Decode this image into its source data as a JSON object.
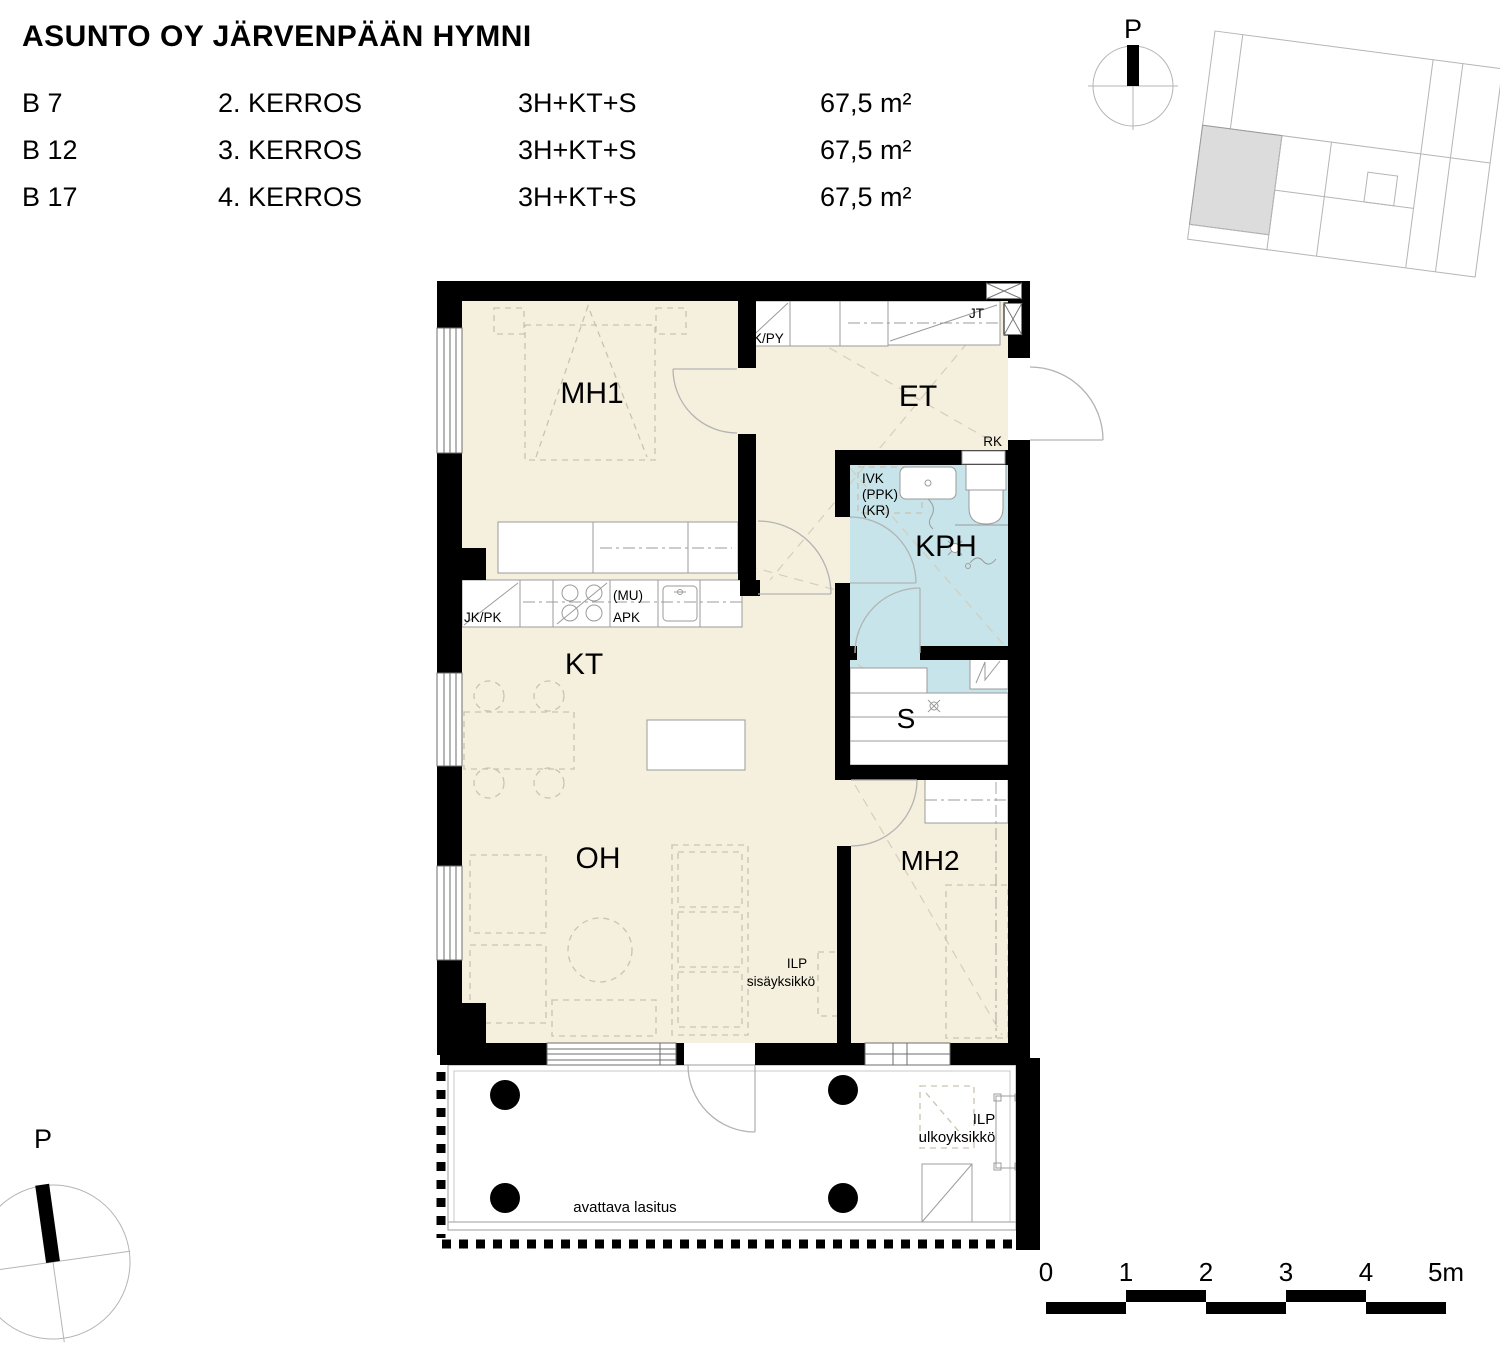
{
  "header": {
    "title": "ASUNTO OY JÄRVENPÄÄN HYMNI"
  },
  "apartments": [
    {
      "unit": "B 7",
      "floor": "2. KERROS",
      "type": "3H+KT+S",
      "area": "67,5 m²"
    },
    {
      "unit": "B 12",
      "floor": "3. KERROS",
      "type": "3H+KT+S",
      "area": "67,5 m²"
    },
    {
      "unit": "B 17",
      "floor": "4. KERROS",
      "type": "3H+KT+S",
      "area": "67,5 m²"
    }
  ],
  "compass_top": {
    "north_label": "P"
  },
  "compass_bottom": {
    "north_label": "P"
  },
  "plan": {
    "rooms": {
      "mh1": "MH1",
      "et": "ET",
      "kph": "KPH",
      "kt": "KT",
      "oh": "OH",
      "s": "S",
      "mh2": "MH2"
    },
    "labels": {
      "sk_py": "SK/PY",
      "jt": "JT",
      "rk": "RK",
      "ivk": "IVK",
      "ppk": "(PPK)",
      "kr": "(KR)",
      "jk_pk": "JK/PK",
      "mu": "(MU)",
      "apk": "APK",
      "ilp_indoor_line1": "ILP",
      "ilp_indoor_line2": "sisäyksikkö",
      "ilp_outdoor_line1": "ILP",
      "ilp_outdoor_line2": "ulkoyksikkö",
      "balcony_glazing": "avattava lasitus"
    }
  },
  "scale_bar": {
    "labels": [
      "0",
      "1",
      "2",
      "3",
      "4",
      "5m"
    ]
  },
  "colors": {
    "room_fill": "#f5f0dd",
    "wet_room_fill": "#c6e4e9",
    "wall": "#000000",
    "highlight_unit": "#dcdcdc",
    "furniture_line": "#c9c3b0",
    "fixture_line": "#9b9b9b"
  }
}
